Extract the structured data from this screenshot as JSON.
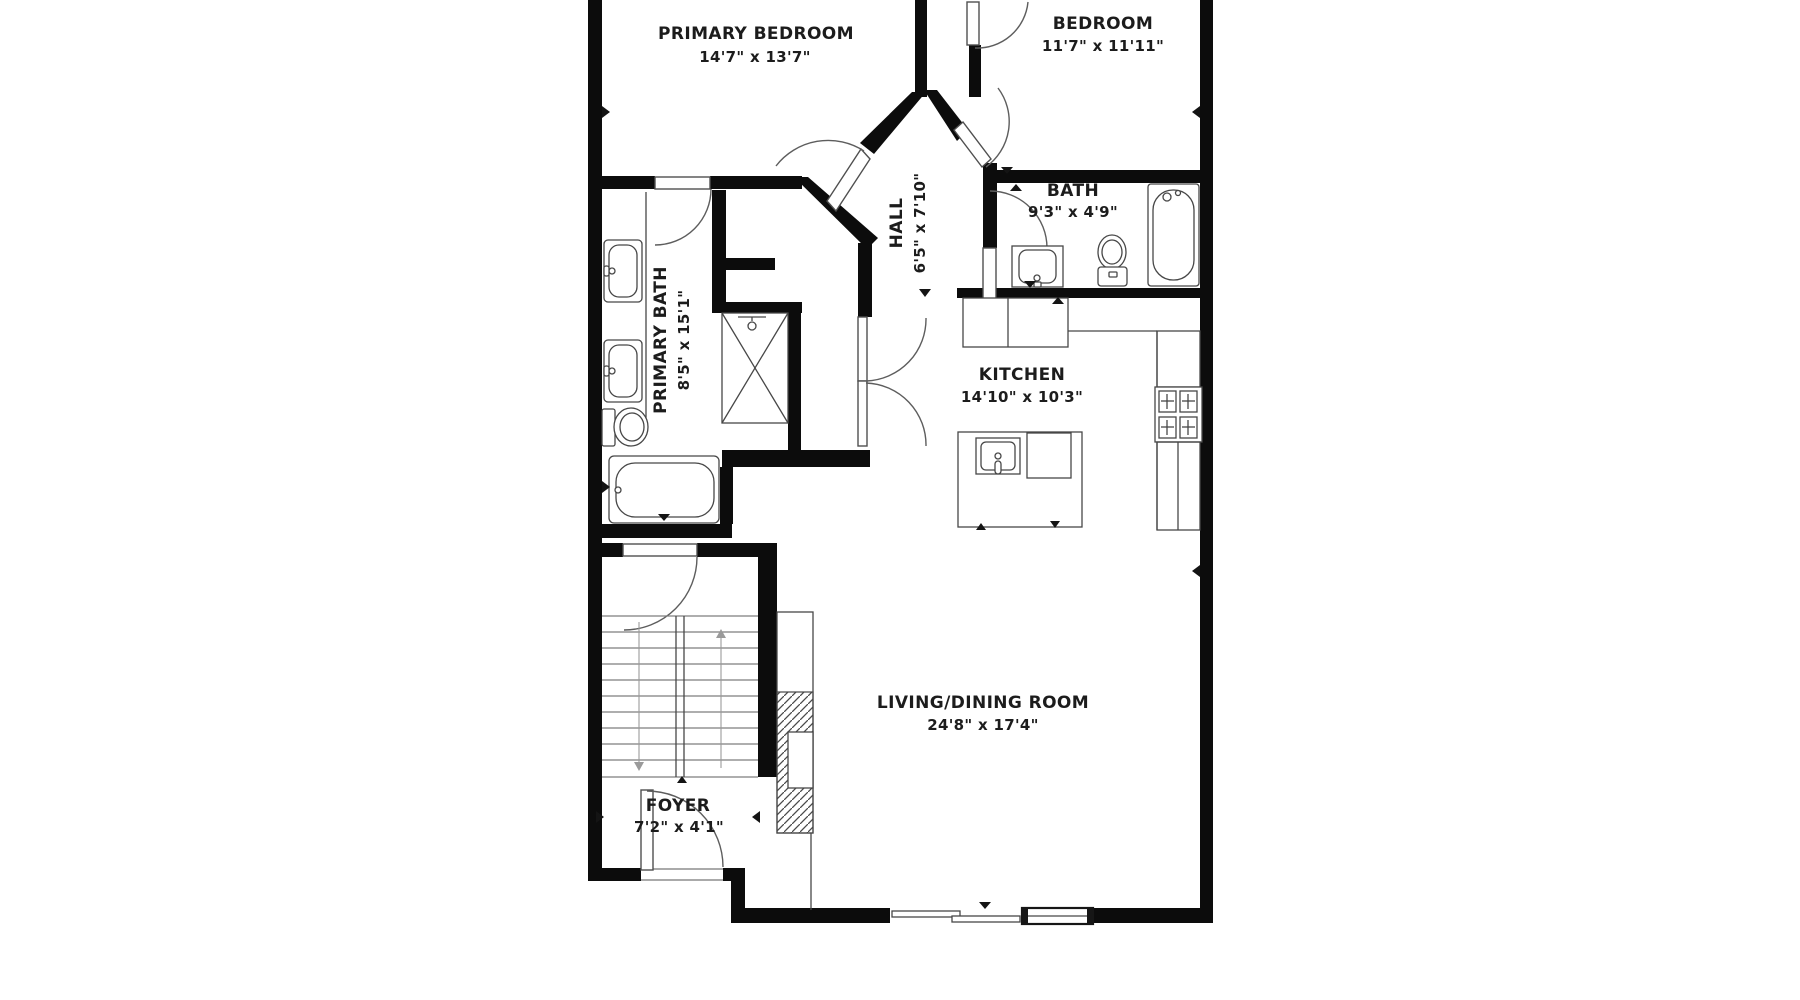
{
  "rooms": {
    "primary_bedroom": {
      "name": "PRIMARY BEDROOM",
      "dims": "14'7\" x 13'7\""
    },
    "bedroom": {
      "name": "BEDROOM",
      "dims": "11'7\" x 11'11\""
    },
    "bath": {
      "name": "BATH",
      "dims": "9'3\" x 4'9\""
    },
    "hall": {
      "name": "HALL",
      "dims": "6'5\" x 7'10\""
    },
    "primary_bath": {
      "name": "PRIMARY BATH",
      "dims": "8'5\" x 15'1\""
    },
    "kitchen": {
      "name": "KITCHEN",
      "dims": "14'10\" x 10'3\""
    },
    "living_dining": {
      "name": "LIVING/DINING ROOM",
      "dims": "24'8\" x 17'4\""
    },
    "foyer": {
      "name": "FOYER",
      "dims": "7'2\" x 4'1\""
    }
  },
  "colors": {
    "wall": "#0c0c0c",
    "background": "#ffffff",
    "fixture_line": "#474747",
    "text": "#1c1c1c"
  }
}
